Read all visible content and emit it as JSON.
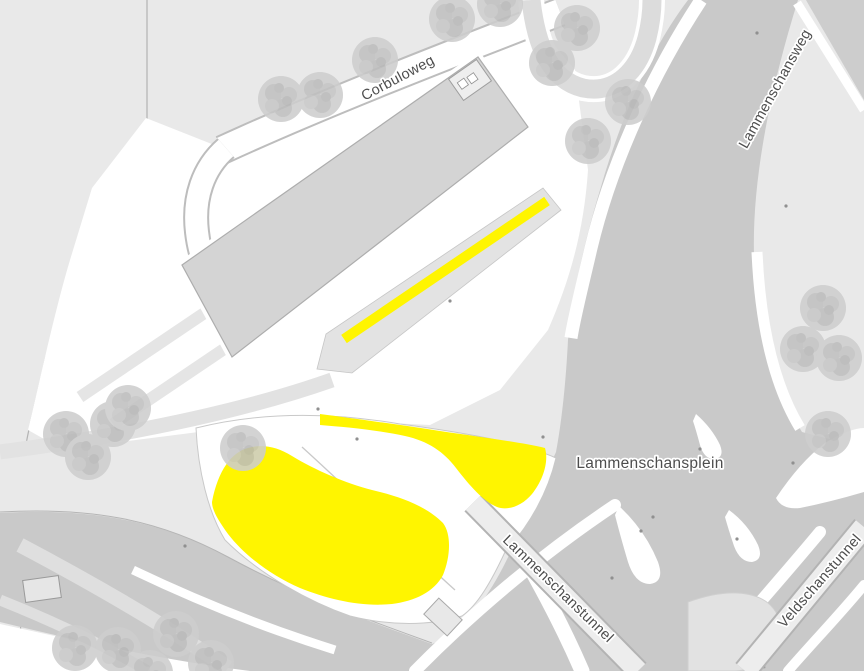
{
  "map": {
    "street_labels": {
      "corbuloweg": "Corbuloweg",
      "lammenschansweg": "Lammenschansweg",
      "lammenschansplein": "Lammenschansplein",
      "lammenschanstunnel": "Lammenschanstunnel",
      "veldschanstunnel": "Veldschanstunnel"
    },
    "colors": {
      "background": "#e9e9e9",
      "road": "#c9c9c9",
      "road_light": "#e0e0e0",
      "white_area": "#ffffff",
      "building": "#d4d4d4",
      "tunnel_band": "#ededed",
      "tree": "#cdcdcd",
      "highlight": "#fff500",
      "label_text": "#4d4d4d"
    },
    "highlights": {
      "color": "#fff500",
      "items": [
        "highlight-line-platform",
        "highlight-area-west",
        "highlight-area-east"
      ]
    }
  }
}
